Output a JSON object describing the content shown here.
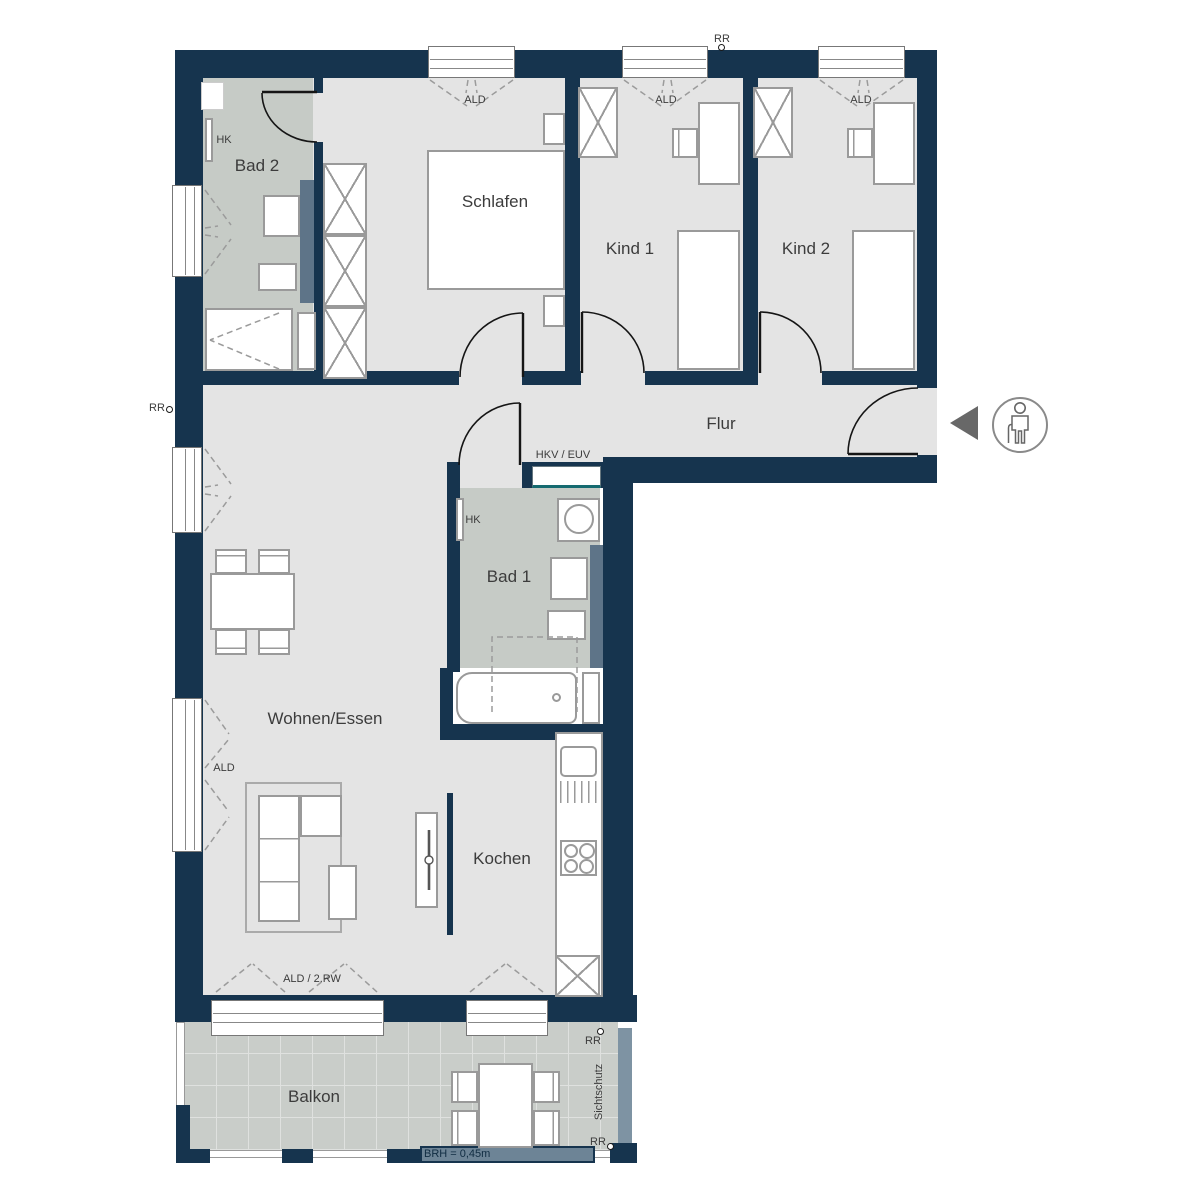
{
  "rooms": [
    {
      "id": "bad2",
      "label": "Bad 2"
    },
    {
      "id": "schlafen",
      "label": "Schlafen"
    },
    {
      "id": "kind1",
      "label": "Kind 1"
    },
    {
      "id": "kind2",
      "label": "Kind 2"
    },
    {
      "id": "flur",
      "label": "Flur"
    },
    {
      "id": "bad1",
      "label": "Bad 1"
    },
    {
      "id": "wohnen",
      "label": "Wohnen/Essen"
    },
    {
      "id": "kochen",
      "label": "Kochen"
    },
    {
      "id": "balkon",
      "label": "Balkon"
    }
  ],
  "annotations": {
    "ald": "ALD",
    "ald_2rw": "ALD / 2.RW",
    "hk": "HK",
    "rr": "RR",
    "hkv_euv": "HKV / EUV",
    "sichtschutz": "Sichtschutz",
    "brh": "BRH = 0,45m"
  },
  "icons": {
    "entrance_arrow": "entrance-direction-triangle",
    "person": "person-with-cane-icon"
  },
  "colors": {
    "wall": "#16344e",
    "floor": "#e4e4e4",
    "wet_floor": "#c6cbc6",
    "balcony_tile": "#c9cdc9",
    "installation_wall": "#5e7488",
    "privacy_screen": "#7e93a3",
    "railing_bar": "#6d8496",
    "furniture_line": "#9a9a9a",
    "door_line": "#151515",
    "label_text": "#3c3c3c",
    "accent_teal": "#156a70"
  }
}
